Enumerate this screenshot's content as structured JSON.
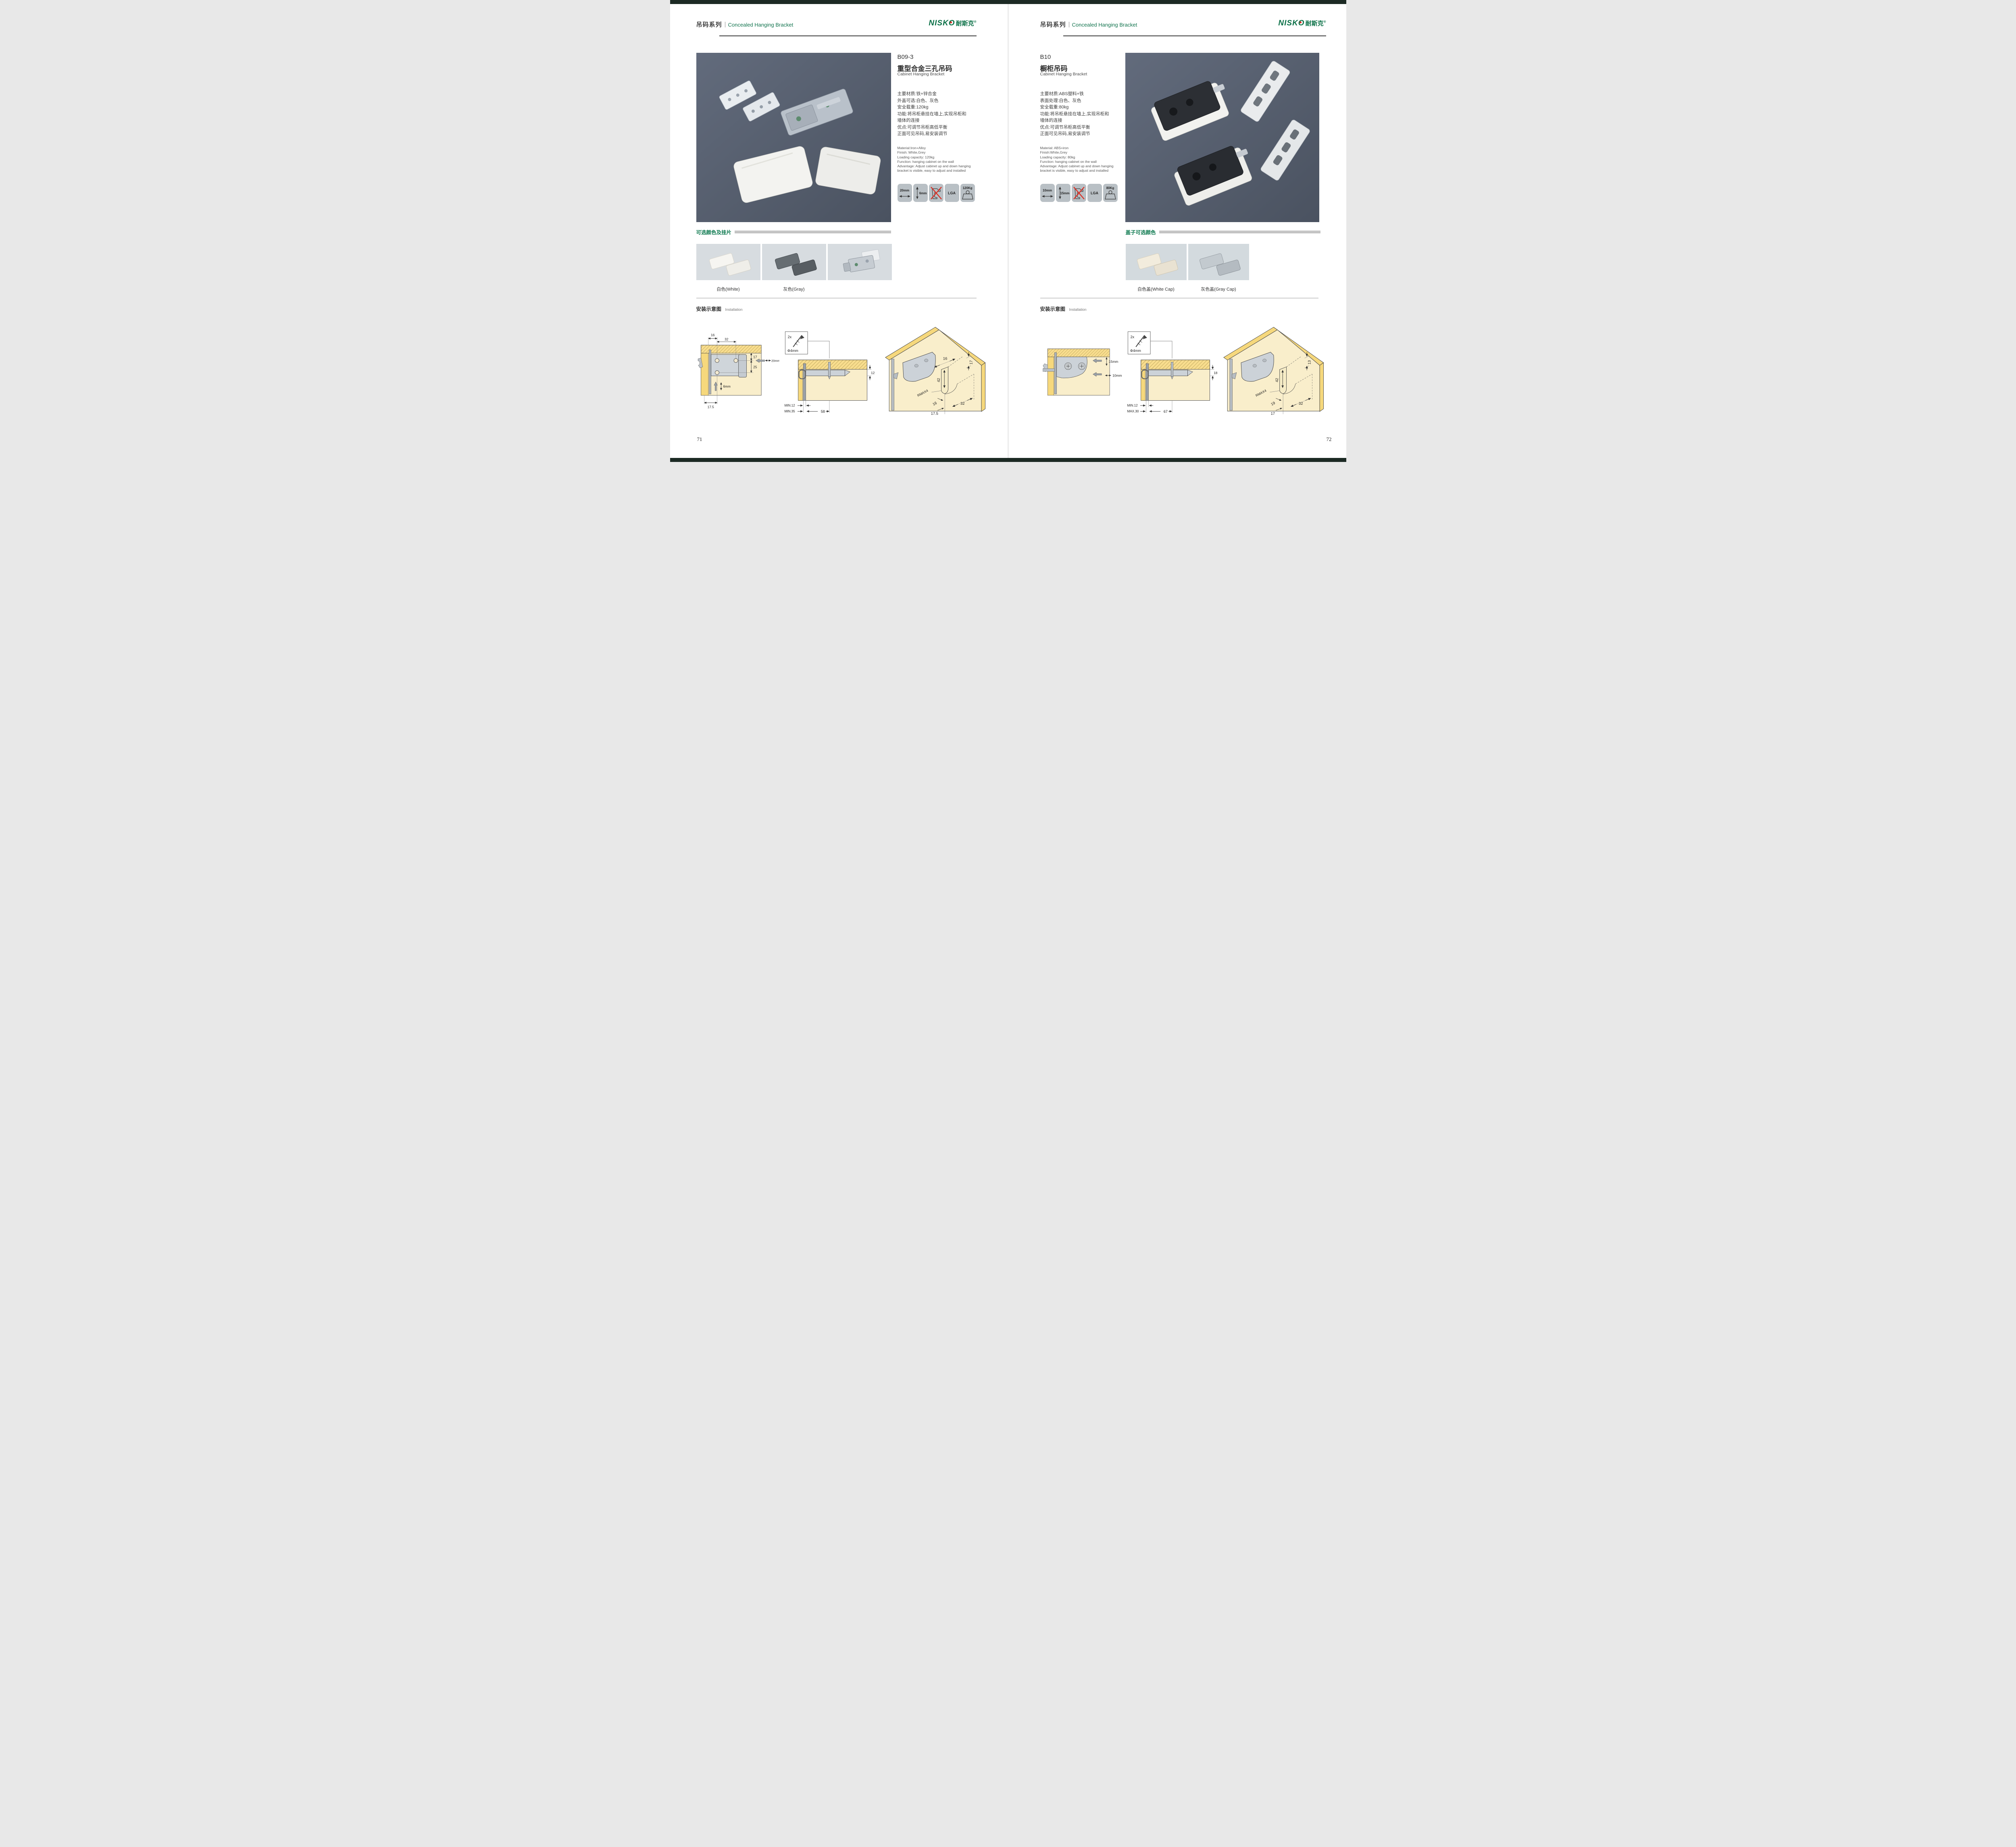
{
  "brand": {
    "latin": "NISKO",
    "cn": "耐斯克",
    "reg": "®"
  },
  "left": {
    "page_no": "71",
    "header": {
      "series": "吊码系列",
      "subtitle": "Concealed Hanging Bracket"
    },
    "product": {
      "code": "B09-3",
      "name_cn": "重型合金三孔吊码",
      "name_en": "Cabinet Hanging Bracket",
      "specs_cn": [
        "主要材质:铁+锌合金",
        "外盖可选:白色、灰色",
        "安全载重:120kg",
        "功能:将吊柜悬挂在墙上,实现吊柜和",
        "墙体的连接",
        "优点:可调节吊柜高低平衡",
        "正面可见吊码,易安装调节"
      ],
      "specs_en": [
        "Material:Iron+Alloy",
        "Finish: White,Grey",
        "Loading capacity: 120kg",
        "Function: hanging cabinet on the wall",
        "Advantage: Adjust cabinet up and down hanging",
        "bracket is visible, easy to adjust and installed"
      ],
      "icons": [
        {
          "label": "20mm"
        },
        {
          "label": "6mm"
        },
        {
          "label": ""
        },
        {
          "label": "LGA"
        },
        {
          "label": "120Kg"
        }
      ]
    },
    "colors": {
      "heading": "可选颜色及挂片",
      "labels": [
        "白色(White)",
        "灰色(Gray)"
      ]
    },
    "install": {
      "heading_cn": "安装示意图",
      "heading_en": "Installation",
      "d1": {
        "a": "16",
        "b": "32",
        "c": "17",
        "d": "25",
        "e": "20mm",
        "f": "6mm",
        "g": "17.5"
      },
      "d2": {
        "qty": "2x",
        "dia": "Φ4mm",
        "a": "12",
        "b": "MIN.12",
        "c": "MIN.35",
        "d": "58"
      },
      "d3": {
        "a": "16",
        "b": "17",
        "c": "42",
        "r": "RMAX4",
        "d": "16",
        "e": "32",
        "f": "17.5"
      }
    }
  },
  "right": {
    "page_no": "72",
    "header": {
      "series": "吊码系列",
      "subtitle": "Concealed Hanging Bracket"
    },
    "product": {
      "code": "B10",
      "name_cn": "橱柜吊码",
      "name_en": "Cabinet Hanging Bracket",
      "specs_cn": [
        "主要材质:ABS塑料+铁",
        "表面处理:白色、灰色",
        "安全载重:80kg",
        "功能:将吊柜悬挂在墙上,实现吊柜和",
        "墙体的连接",
        "优点:可调节吊柜高低平衡",
        "正面可见吊码,易安装调节"
      ],
      "specs_en": [
        "Material: ABS+iron",
        "Finish:White,Grey",
        "Loading capacity: 80kg",
        "Function: hanging cabinet on the wall",
        "Advantage: Adjust cabinet up and down hanging",
        "bracket is visible, easy to adjust and installed"
      ],
      "icons": [
        {
          "label": "10mm"
        },
        {
          "label": "15mm"
        },
        {
          "label": ""
        },
        {
          "label": "LGA"
        },
        {
          "label": "80Kg"
        }
      ]
    },
    "colors": {
      "heading": "盖子可选颜色",
      "labels": [
        "白色盖(White Cap)",
        "灰色盖(Gray Cap)"
      ]
    },
    "install": {
      "heading_cn": "安装示意图",
      "heading_en": "Installation",
      "d1": {
        "a": "15mm",
        "b": "10mm"
      },
      "d2": {
        "qty": "2x",
        "dia": "Φ4mm",
        "a": "18",
        "b": "MIN.12",
        "c": "MAX.30",
        "d": "67"
      },
      "d3": {
        "b": "13",
        "c": "42",
        "r": "RMAX4",
        "d": "19",
        "e": "32",
        "f": "17"
      }
    }
  }
}
